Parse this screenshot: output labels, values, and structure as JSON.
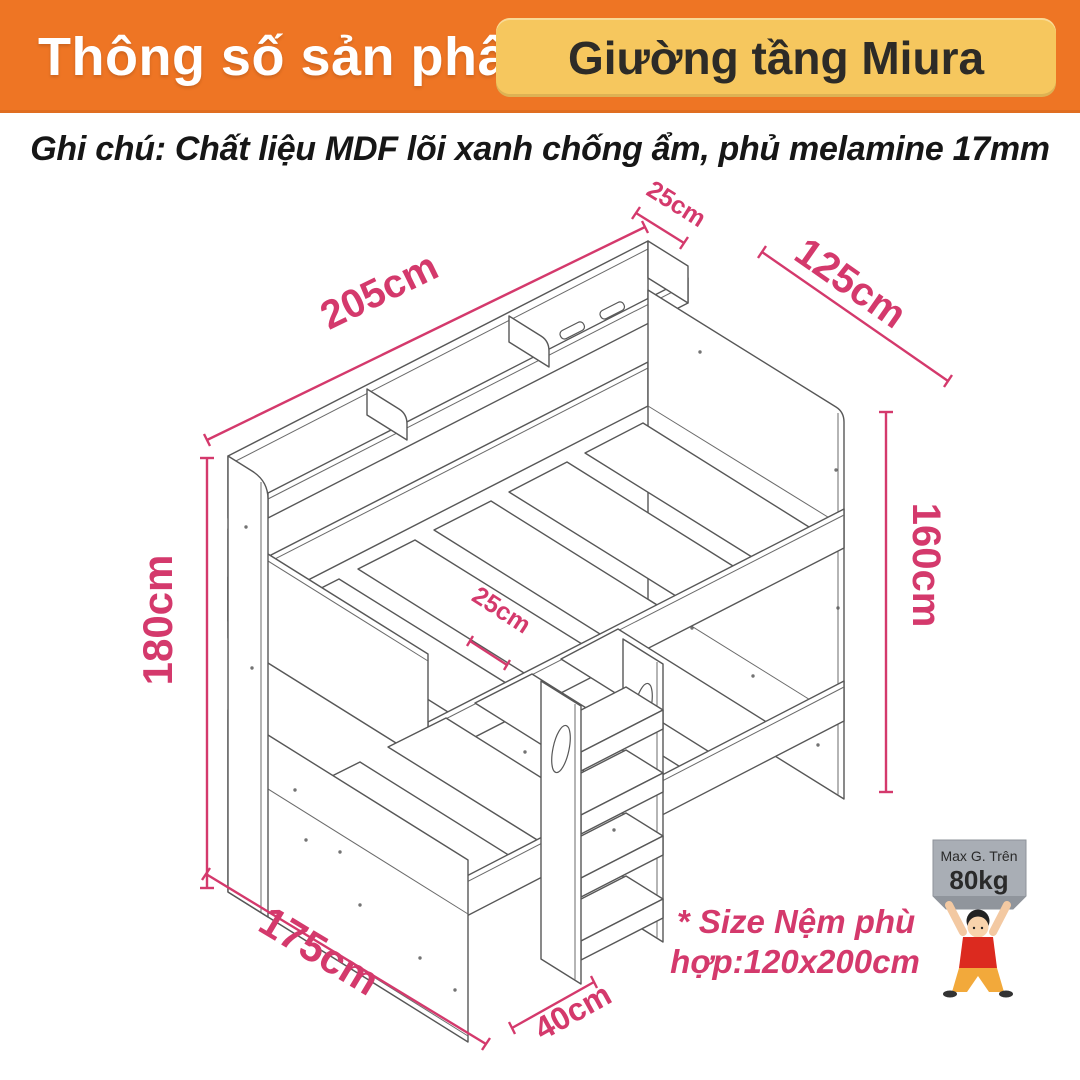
{
  "header": {
    "title": "Thông số sản phẩm",
    "product_name": "Giường tầng Miura"
  },
  "note": "Ghi chú: Chất liệu MDF lõi xanh chống ẩm, phủ melamine 17mm",
  "dimensions": {
    "shelf_depth": "25cm",
    "length": "205cm",
    "width": "125cm",
    "height_right": "160cm",
    "height_left": "180cm",
    "ladder_depth": "25cm",
    "base_depth": "175cm",
    "ladder_width": "40cm"
  },
  "mattress_note": {
    "line1": "* Size Nệm phù",
    "line2": "hợp:120x200cm"
  },
  "weight_limit": {
    "label": "Max G. Trên",
    "value": "80kg"
  },
  "colors": {
    "header_bg": "#EE7524",
    "badge_bg": "#F6C75E",
    "accent_pink": "#D4396C",
    "line_gray": "#575757"
  }
}
